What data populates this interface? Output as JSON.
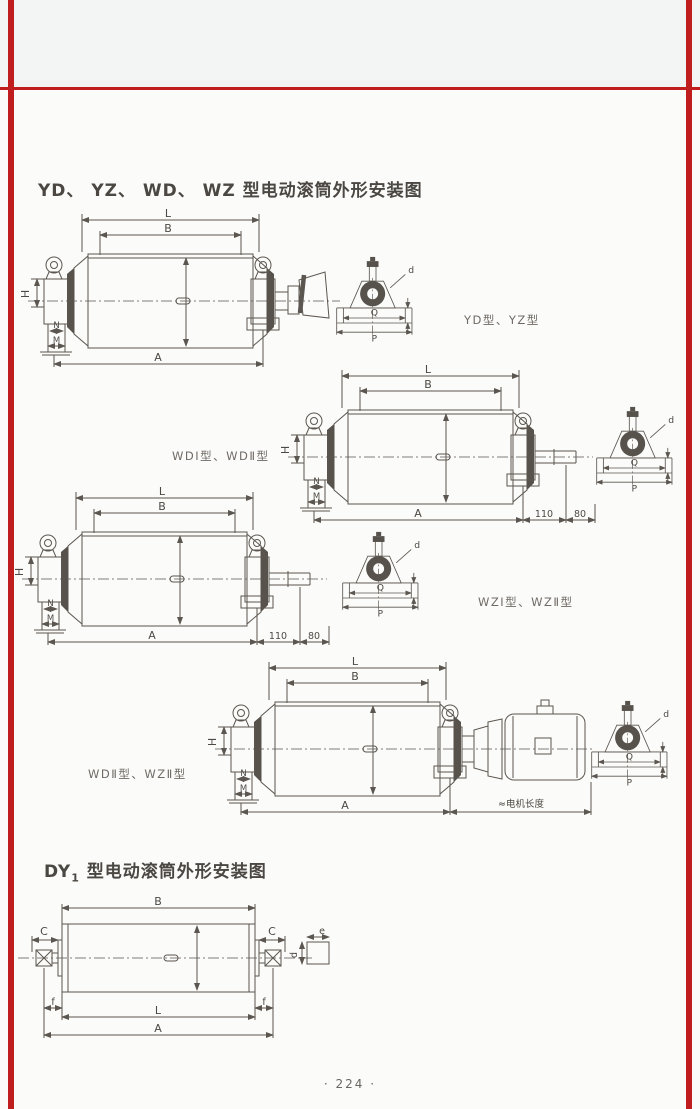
{
  "page": {
    "background": "#fbfbfa",
    "accent_red": "#c01e1e",
    "line_color": "#5b564f",
    "title_main": "YD、 YZ、 WD、 WZ 型电动滚筒外形安装图",
    "title_dy_prefix": "DY",
    "title_dy_sub": "1",
    "title_dy_rest": " 型电动滚筒外形安装图",
    "page_number": "· 224 ·"
  },
  "captions": {
    "d1": "YD型、YZ型",
    "d2": "WDⅠ型、WDⅡ型",
    "d3": "WZⅠ型、WZⅡ型",
    "d4": "WDⅡ型、WZⅡ型"
  },
  "dims": {
    "L": "L",
    "B": "B",
    "A": "A",
    "H": "H",
    "N": "N",
    "M": "M",
    "Q": "Q",
    "P": "P",
    "d": "d",
    "C": "C",
    "f": "f",
    "e": "e",
    "ext110": "110",
    "ext80": "80",
    "motor_length": "≈电机长度"
  }
}
